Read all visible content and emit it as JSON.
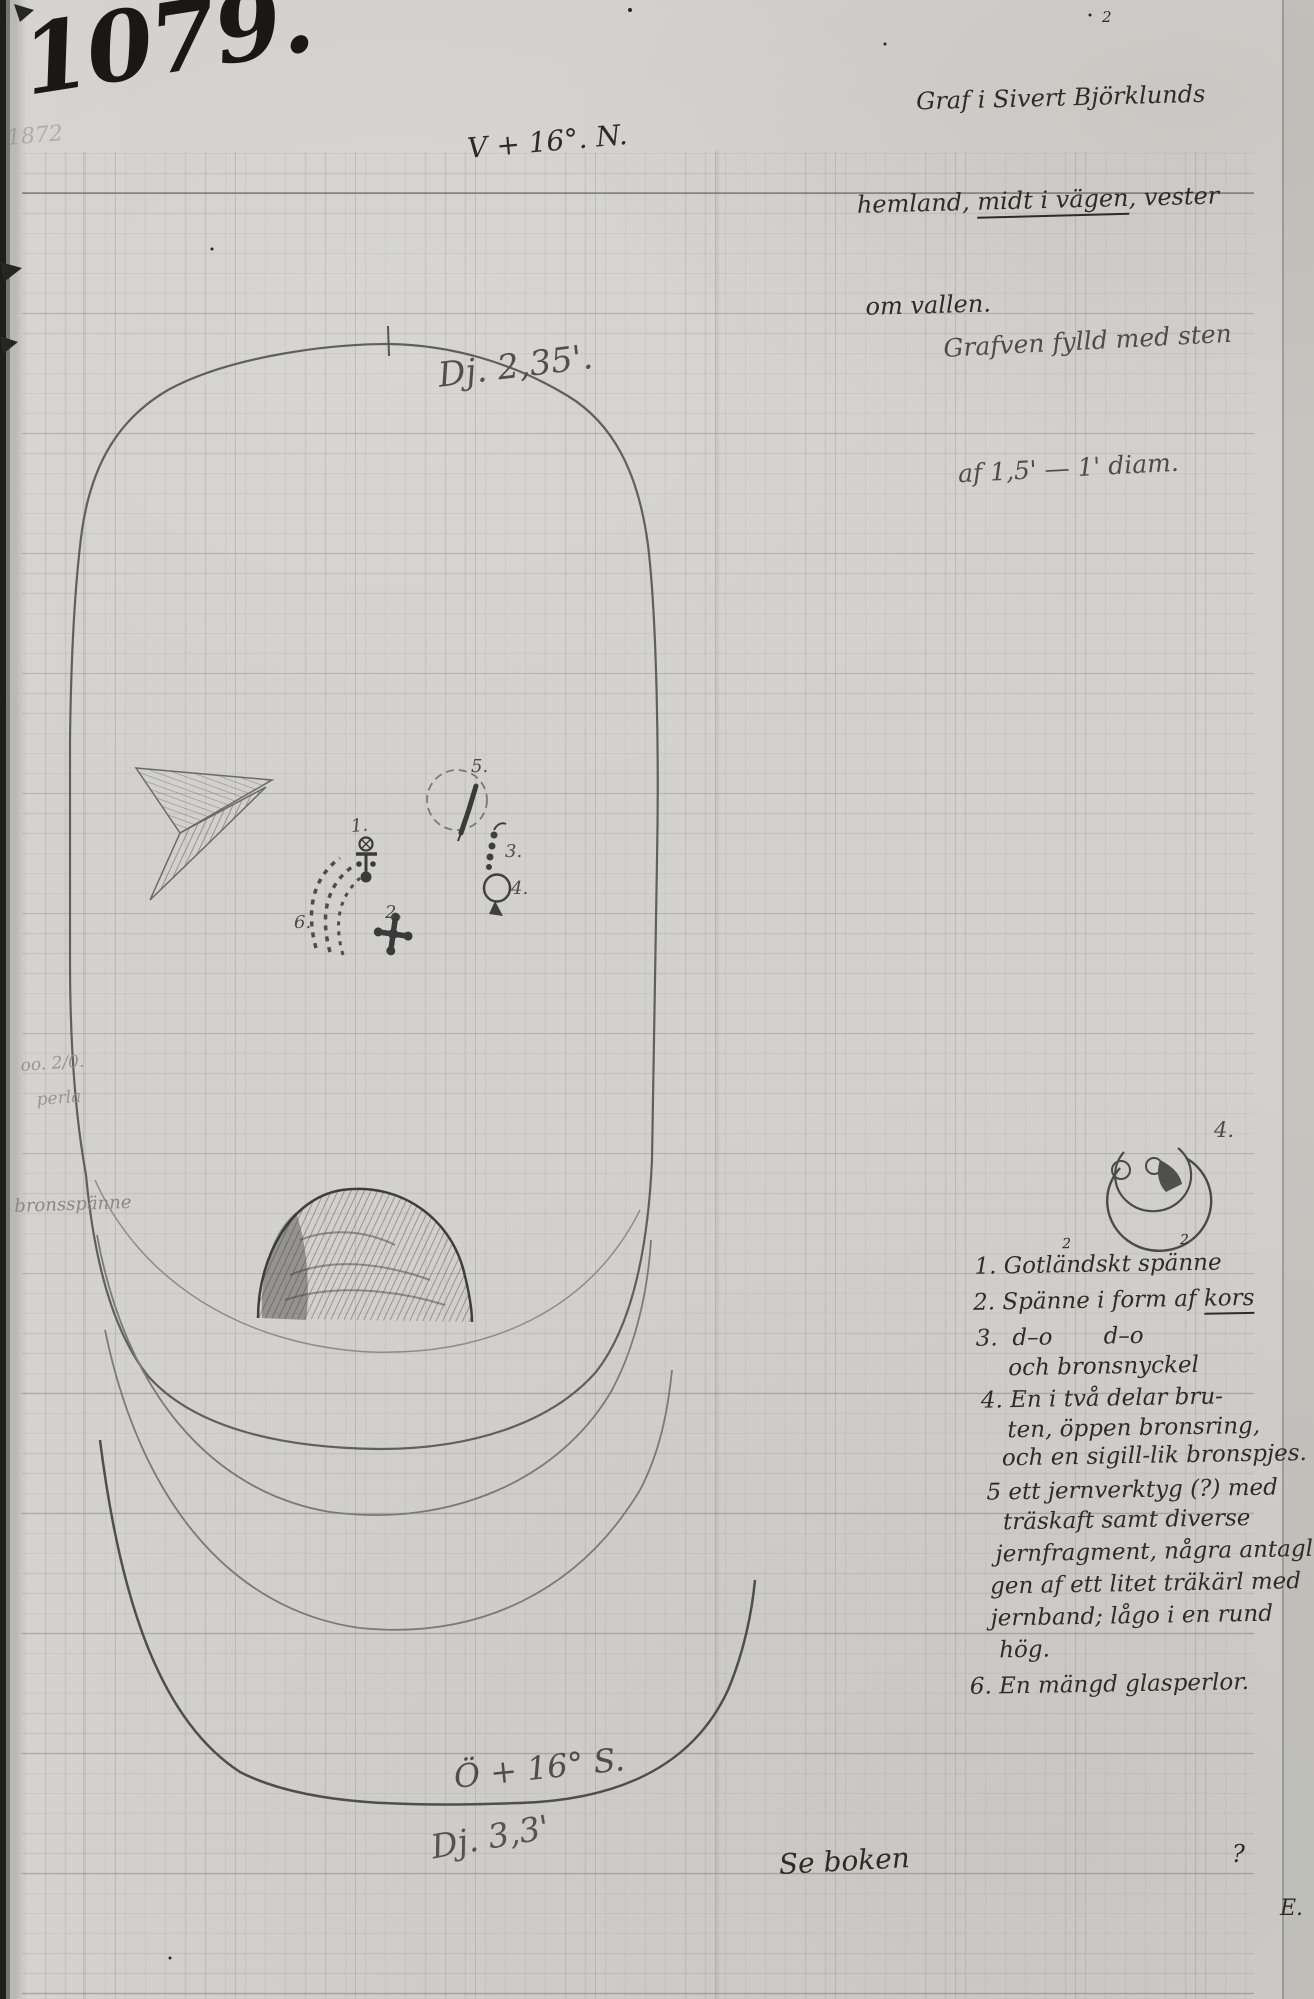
{
  "colors": {
    "paper": "#d3d1cd",
    "ink": "#2e2a26",
    "pencil": "#55534f",
    "pencil_faint": "#989590"
  },
  "header": {
    "inventory_number": "1079.",
    "ghost_year": "1872",
    "note_sup": "2",
    "note_line1": "Graf i Sivert Björklunds",
    "note_line2_pre": "hemland, ",
    "note_line2_underlined": "midt i vägen",
    "note_line2_post": ", vester",
    "note_line3": "om vallen."
  },
  "plan": {
    "bearing_top": "V + 16°. N.",
    "depth_top": "Dj. 2,35'.",
    "bearing_bottom": "Ö + 16° S.",
    "depth_bottom": "Dj. 3,3'",
    "fill_note_line1": "Grafven fylld med sten",
    "fill_note_line2": "af 1,5' — 1' diam.",
    "margin_note_line1": "oo. 2/0.",
    "margin_note_line2": "perla",
    "margin_note_line3": "bronsspänne",
    "marker_1": "1.",
    "marker_2": "2.",
    "marker_3": "3.",
    "marker_4": "4.",
    "marker_5": "5.",
    "marker_6": "6.",
    "ring_marker": "4."
  },
  "find_list": {
    "sup_a": "2",
    "sup_b": "2",
    "line_1": "1. Gotländskt spänne",
    "line_2_pre": "2. Spänne i form af ",
    "line_2_underlined": "kors",
    "line_3": "3.  d–o       d–o",
    "line_4": "och bronsnyckel",
    "line_5": "4. En i två delar bru-",
    "line_6": "ten, öppen bronsring,",
    "line_7": "och en sigill-lik bronspjes.",
    "line_8": "5 ett jernverktyg (?) med",
    "line_9": "träskaft samt diverse",
    "line_10": "jernfragment, några antagli-",
    "line_11": "gen af ett litet träkärl med",
    "line_12": "jernband; lågo i en rund",
    "line_13": "hög.",
    "line_14": "6. En mängd glasperlor."
  },
  "footer": {
    "reference": "Se boken",
    "mark": "?",
    "initial": "E."
  }
}
